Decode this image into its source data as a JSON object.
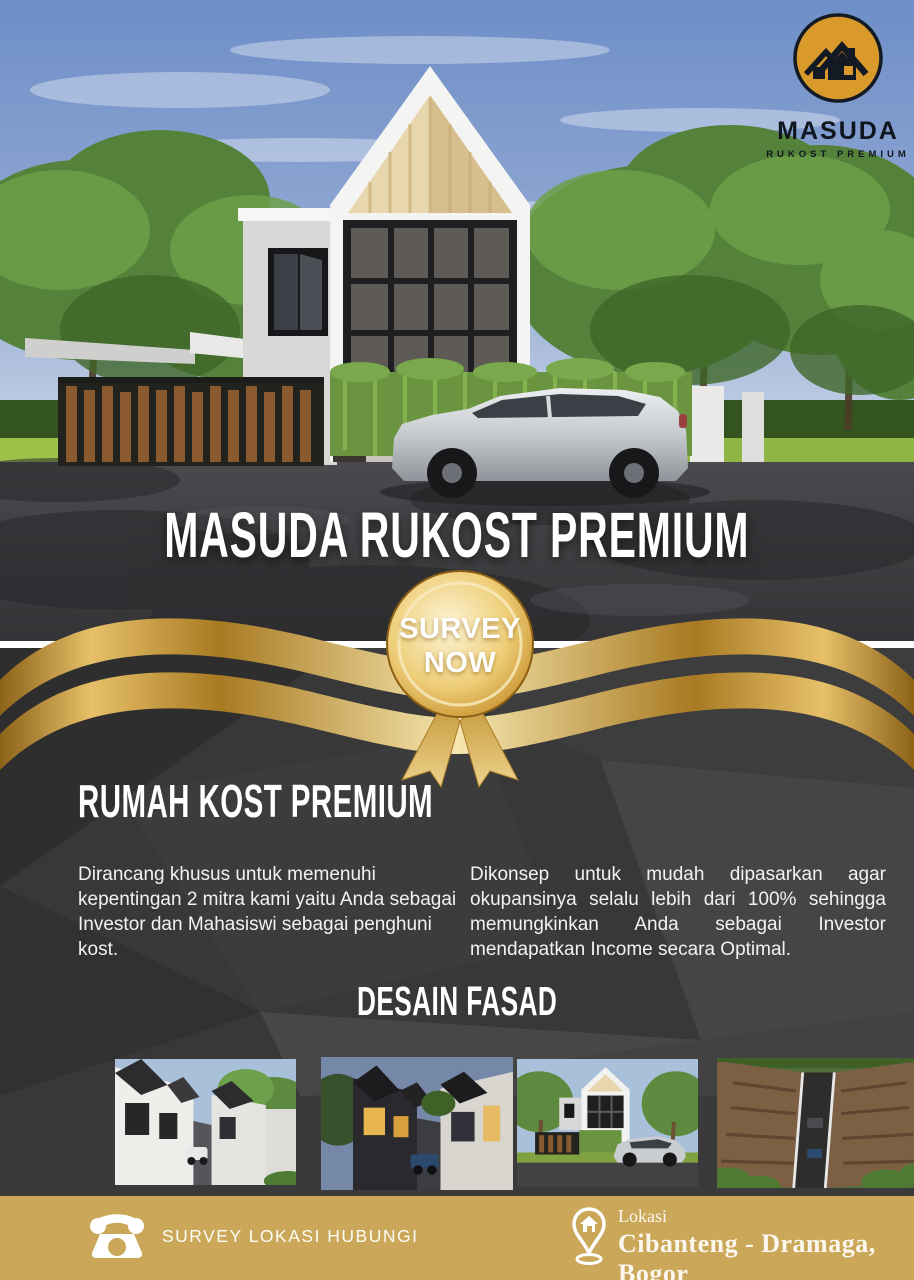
{
  "logo": {
    "brand": "MASUDA",
    "tagline": "RUKOST PREMIUM"
  },
  "hero": {
    "title": "MASUDA RUKOST PREMIUM"
  },
  "badge": {
    "line1": "SURVEY",
    "line2": "NOW"
  },
  "about": {
    "heading": "RUMAH KOST PREMIUM",
    "paragraph_left": "Dirancang khusus untuk memenuhi kepentingan 2 mitra kami yaitu Anda sebagai Investor dan Mahasiswi sebagai penghuni kost.",
    "paragraph_right": "Dikonsep untuk mudah dipasarkan agar okupansinya selalu lebih dari 100% sehingga memungkinkan Anda sebagai Investor mendapatkan Income secara Optimal."
  },
  "gallery": {
    "heading": "DESAIN FASAD",
    "items": [
      {
        "name": "row-houses-street-view-day"
      },
      {
        "name": "row-houses-street-view-dusk"
      },
      {
        "name": "front-facade-with-car"
      },
      {
        "name": "aerial-view-rooftops"
      }
    ]
  },
  "footer": {
    "contact_label": "SURVEY LOKASI HUBUNGI",
    "location_label": "Lokasi",
    "location_value": "Cibanteng - Dramaga, Bogor"
  },
  "colors": {
    "footer_gold": "#cba75a",
    "ribbon_gold": "#d9ab4e",
    "medal_gold": "#e7c161",
    "logo_gold": "#d9992b",
    "dark_background": "#383838",
    "text": "#f2f2f2"
  }
}
